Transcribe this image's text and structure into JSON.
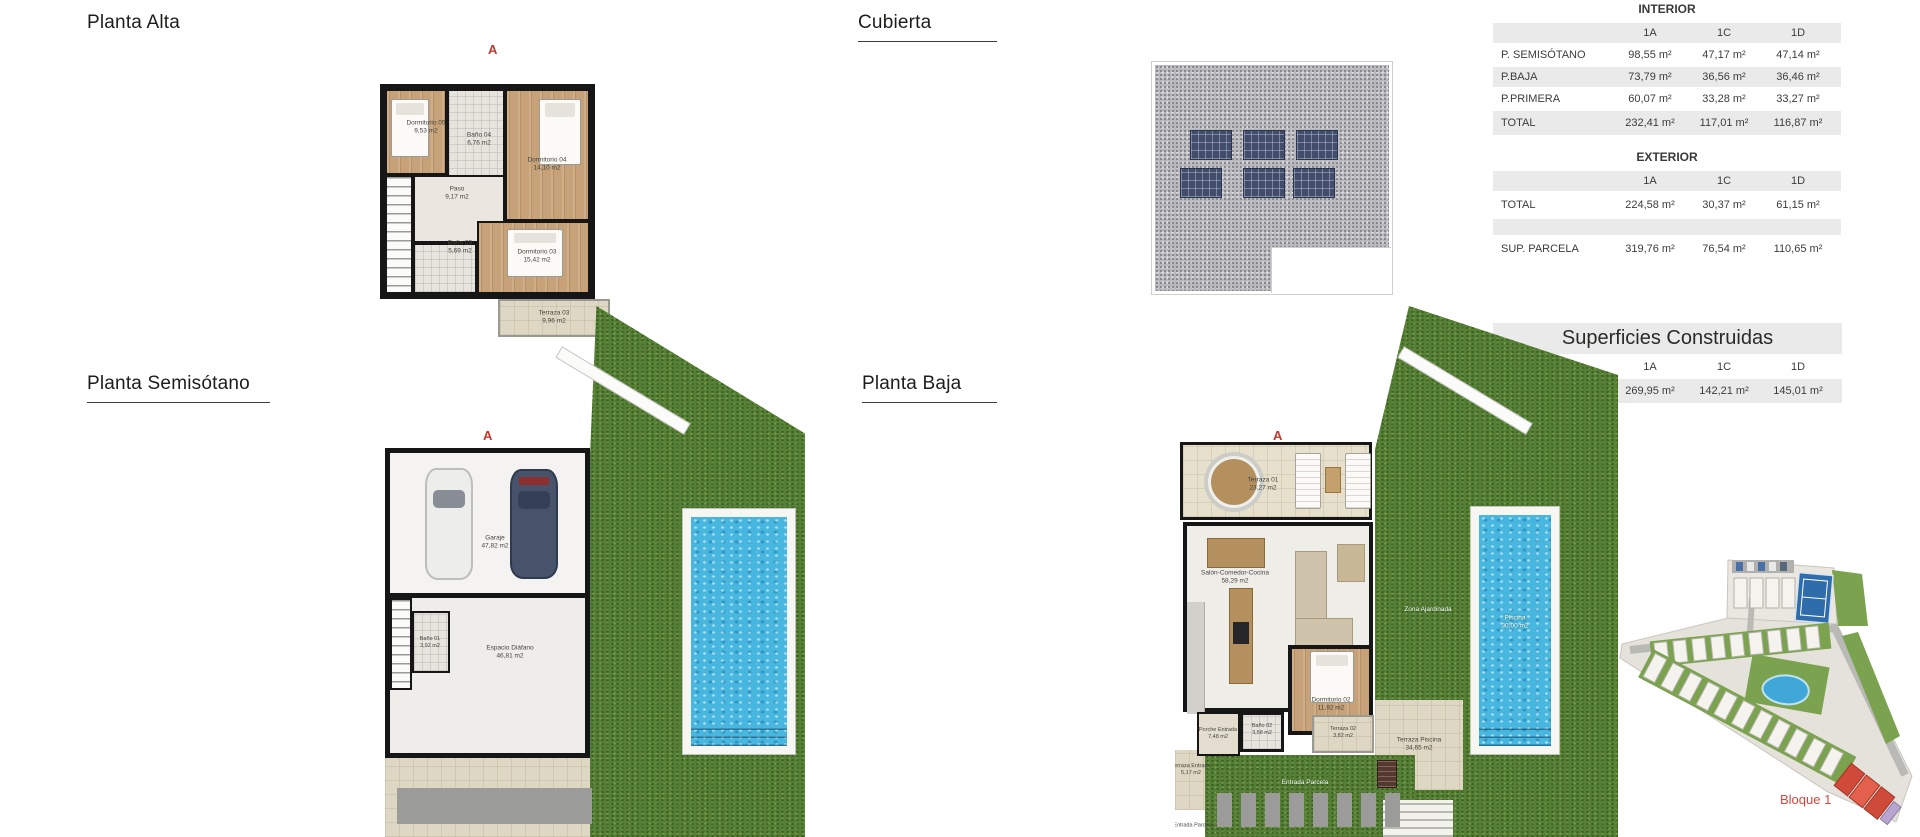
{
  "sections": {
    "planta_alta": {
      "title": "Planta Alta",
      "section_marker": "A"
    },
    "cubierta": {
      "title": "Cubierta"
    },
    "planta_semisotano": {
      "title": "Planta Semisótano",
      "section_marker": "A"
    },
    "planta_baja": {
      "title": "Planta Baja",
      "section_marker": "A"
    }
  },
  "tables": {
    "interior": {
      "title": "INTERIOR",
      "columns": [
        "1A",
        "1C",
        "1D"
      ],
      "rows": [
        {
          "label": "P. SEMISÓTANO",
          "values": [
            "98,55 m²",
            "47,17 m²",
            "47,14 m²"
          ]
        },
        {
          "label": "P.BAJA",
          "values": [
            "73,79 m²",
            "36,56 m²",
            "36,46 m²"
          ]
        },
        {
          "label": "P.PRIMERA",
          "values": [
            "60,07 m²",
            "33,28 m²",
            "33,27 m²"
          ]
        },
        {
          "label": "TOTAL",
          "values": [
            "232,41 m²",
            "117,01 m²",
            "116,87 m²"
          ]
        }
      ]
    },
    "exterior": {
      "title": "EXTERIOR",
      "columns": [
        "1A",
        "1C",
        "1D"
      ],
      "rows": [
        {
          "label": "TOTAL",
          "values": [
            "224,58 m²",
            "30,37 m²",
            "61,15 m²"
          ]
        },
        {
          "label": "SUP. PARCELA",
          "values": [
            "319,76 m²",
            "76,54 m²",
            "110,65 m²"
          ]
        }
      ]
    },
    "construidas": {
      "title": "Superficies Construidas",
      "columns": [
        "1A",
        "1C",
        "1D"
      ],
      "rows": [
        {
          "label": "CONSTRUIDA",
          "values": [
            "269,95 m²",
            "142,21 m²",
            "145,01 m²"
          ]
        }
      ]
    }
  },
  "rooms": {
    "planta_alta": [
      {
        "name": "Dormitorio 05",
        "area": "9,53 m2"
      },
      {
        "name": "Baño 04",
        "area": "6,76 m2"
      },
      {
        "name": "Dormitorio 04",
        "area": "14,10 m2"
      },
      {
        "name": "Paso",
        "area": "9,17 m2"
      },
      {
        "name": "Baño 03",
        "area": "5,69 m2"
      },
      {
        "name": "Dormitorio 03",
        "area": "15,42 m2"
      },
      {
        "name": "Terraza 03",
        "area": "9,96 m2"
      }
    ],
    "planta_semisotano": [
      {
        "name": "Garaje",
        "area": "47,82 m2"
      },
      {
        "name": "Baño 01",
        "area": "3,92 m2"
      },
      {
        "name": "Espacio Diáfano",
        "area": "46,81 m2"
      }
    ],
    "planta_baja": [
      {
        "name": "Terraza 01",
        "area": "23,27 m2"
      },
      {
        "name": "Salón-Comedor-Cocina",
        "area": "58,29 m2"
      },
      {
        "name": "Dormitorio 02",
        "area": "11,92 m2"
      },
      {
        "name": "Baño 02",
        "area": "3,58 m2"
      },
      {
        "name": "Terraza 02",
        "area": "3,82 m2"
      },
      {
        "name": "Porche Entrada",
        "area": "7,48 m2"
      },
      {
        "name": "Terraza Entrada",
        "area": "5,17 m2"
      },
      {
        "name": "Entrada Parcela",
        "area": ""
      },
      {
        "name": "Terraza Piscina",
        "area": "34,65 m2"
      },
      {
        "name": "Piscina",
        "area": "30,00 m2"
      },
      {
        "name": "Zona Ajardinada",
        "area": ""
      },
      {
        "name": "Entrada Parcela",
        "area": ""
      }
    ]
  },
  "site_plan": {
    "block_label": "Bloque 1"
  },
  "colors": {
    "section_marker": "#c0392b",
    "table_row_gray": "#eaeaea",
    "pool_water": "#48b7e0",
    "grass": "#567f36",
    "highlight_block": "#cf4a39",
    "block_label_text": "#d9453a"
  }
}
